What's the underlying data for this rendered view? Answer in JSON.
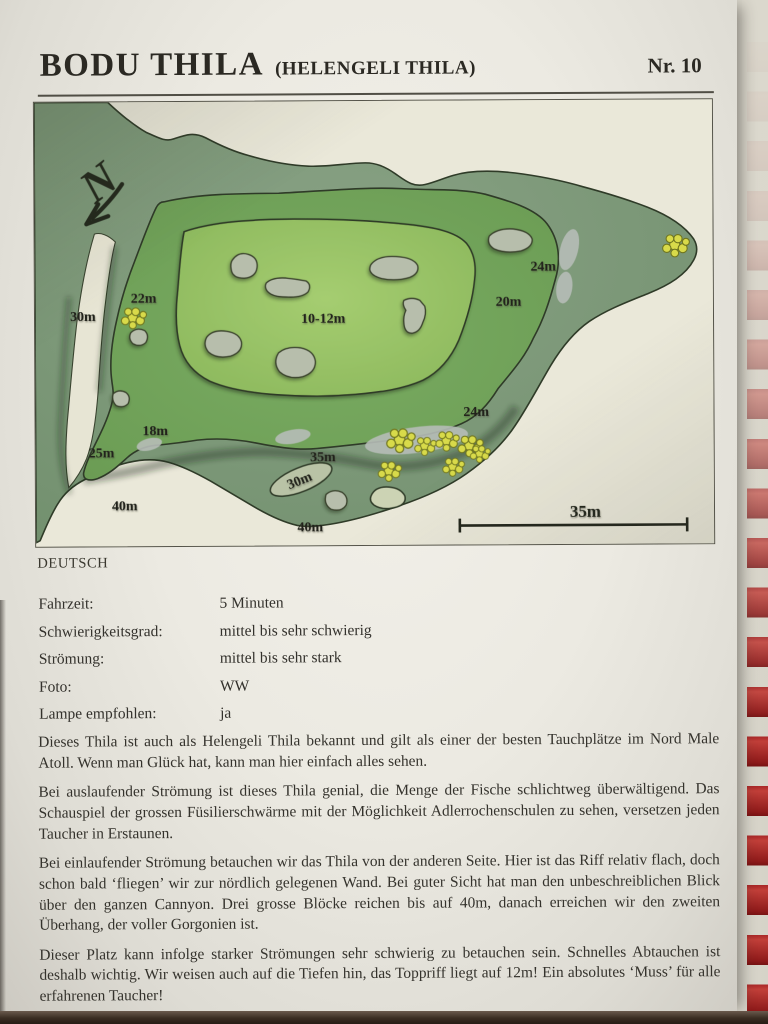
{
  "page": {
    "title": "BODU THILA",
    "subtitle": "(HELENGELI THILA)",
    "page_number": "Nr. 10",
    "language_label": "DEUTSCH"
  },
  "facts": [
    {
      "label": "Fahrzeit:",
      "value": "5 Minuten"
    },
    {
      "label": "Schwierigkeitsgrad:",
      "value": "mittel bis sehr schwierig"
    },
    {
      "label": "Strömung:",
      "value": "mittel bis sehr stark"
    },
    {
      "label": "Foto:",
      "value": "WW"
    },
    {
      "label": "Lampe empfohlen:",
      "value": "ja"
    }
  ],
  "description_paragraphs": [
    "Dieses Thila ist auch als Helengeli Thila bekannt und gilt als einer der besten Tauchplätze im Nord Male Atoll. Wenn man Glück hat, kann man hier einfach alles sehen.",
    "Bei auslaufender Strömung ist dieses Thila genial, die Menge der Fische schlichtweg überwältigend. Das Schauspiel der grossen Füsilierschwärme mit der Möglichkeit Adlerrochenschulen zu sehen, versetzen jeden Taucher in Erstaunen.",
    "Bei einlaufender Strömung betauchen wir das Thila von der anderen Seite. Hier ist das Riff relativ flach, doch schon bald ‘fliegen’ wir zur nördlich gelegenen Wand. Bei guter Sicht hat man den unbeschreiblichen Blick über den ganzen Cannyon. Drei grosse Blöcke reichen bis auf 40m, danach erreichen wir den zweiten Überhang, der voller Gorgonien ist.",
    "Dieser Platz kann infolge starker Strömungen sehr schwierig zu betauchen sein. Schnelles Abtauchen ist deshalb wichtig. Wir weisen auch auf die Tiefen hin, das Toppriff liegt auf 12m! Ein absolutes ‘Muss’ für alle erfahrenen Taucher!"
  ],
  "map": {
    "north_label": "N",
    "scale": {
      "label": "35m"
    },
    "depth_labels": [
      {
        "text": "30m",
        "x": 48,
        "y": 219,
        "rotate": 0
      },
      {
        "text": "22m",
        "x": 109,
        "y": 201,
        "rotate": 0
      },
      {
        "text": "10-12m",
        "x": 289,
        "y": 222,
        "rotate": 0
      },
      {
        "text": "20m",
        "x": 475,
        "y": 206,
        "rotate": 0
      },
      {
        "text": "24m",
        "x": 510,
        "y": 171,
        "rotate": 0
      },
      {
        "text": "24m",
        "x": 442,
        "y": 316,
        "rotate": 0
      },
      {
        "text": "18m",
        "x": 120,
        "y": 334,
        "rotate": 0
      },
      {
        "text": "25m",
        "x": 66,
        "y": 356,
        "rotate": 0
      },
      {
        "text": "35m",
        "x": 288,
        "y": 361,
        "rotate": 0
      },
      {
        "text": "30m",
        "x": 266,
        "y": 384,
        "rotate": -22
      },
      {
        "text": "40m",
        "x": 89,
        "y": 409,
        "rotate": 0
      },
      {
        "text": "40m",
        "x": 275,
        "y": 431,
        "rotate": 0
      }
    ]
  },
  "colors": {
    "paper": "#edebe3",
    "map_background": "#eae8d9",
    "reef_outer": "#7f977b",
    "reef_mid": "#74a75e",
    "reef_top": "#98c368",
    "rock": "#b7beac",
    "sand_patch": "#b6bdb7",
    "coral": "#d8da4a",
    "outline": "#2f3b28",
    "binding_red": "#a32322",
    "ink": "#33312c"
  }
}
